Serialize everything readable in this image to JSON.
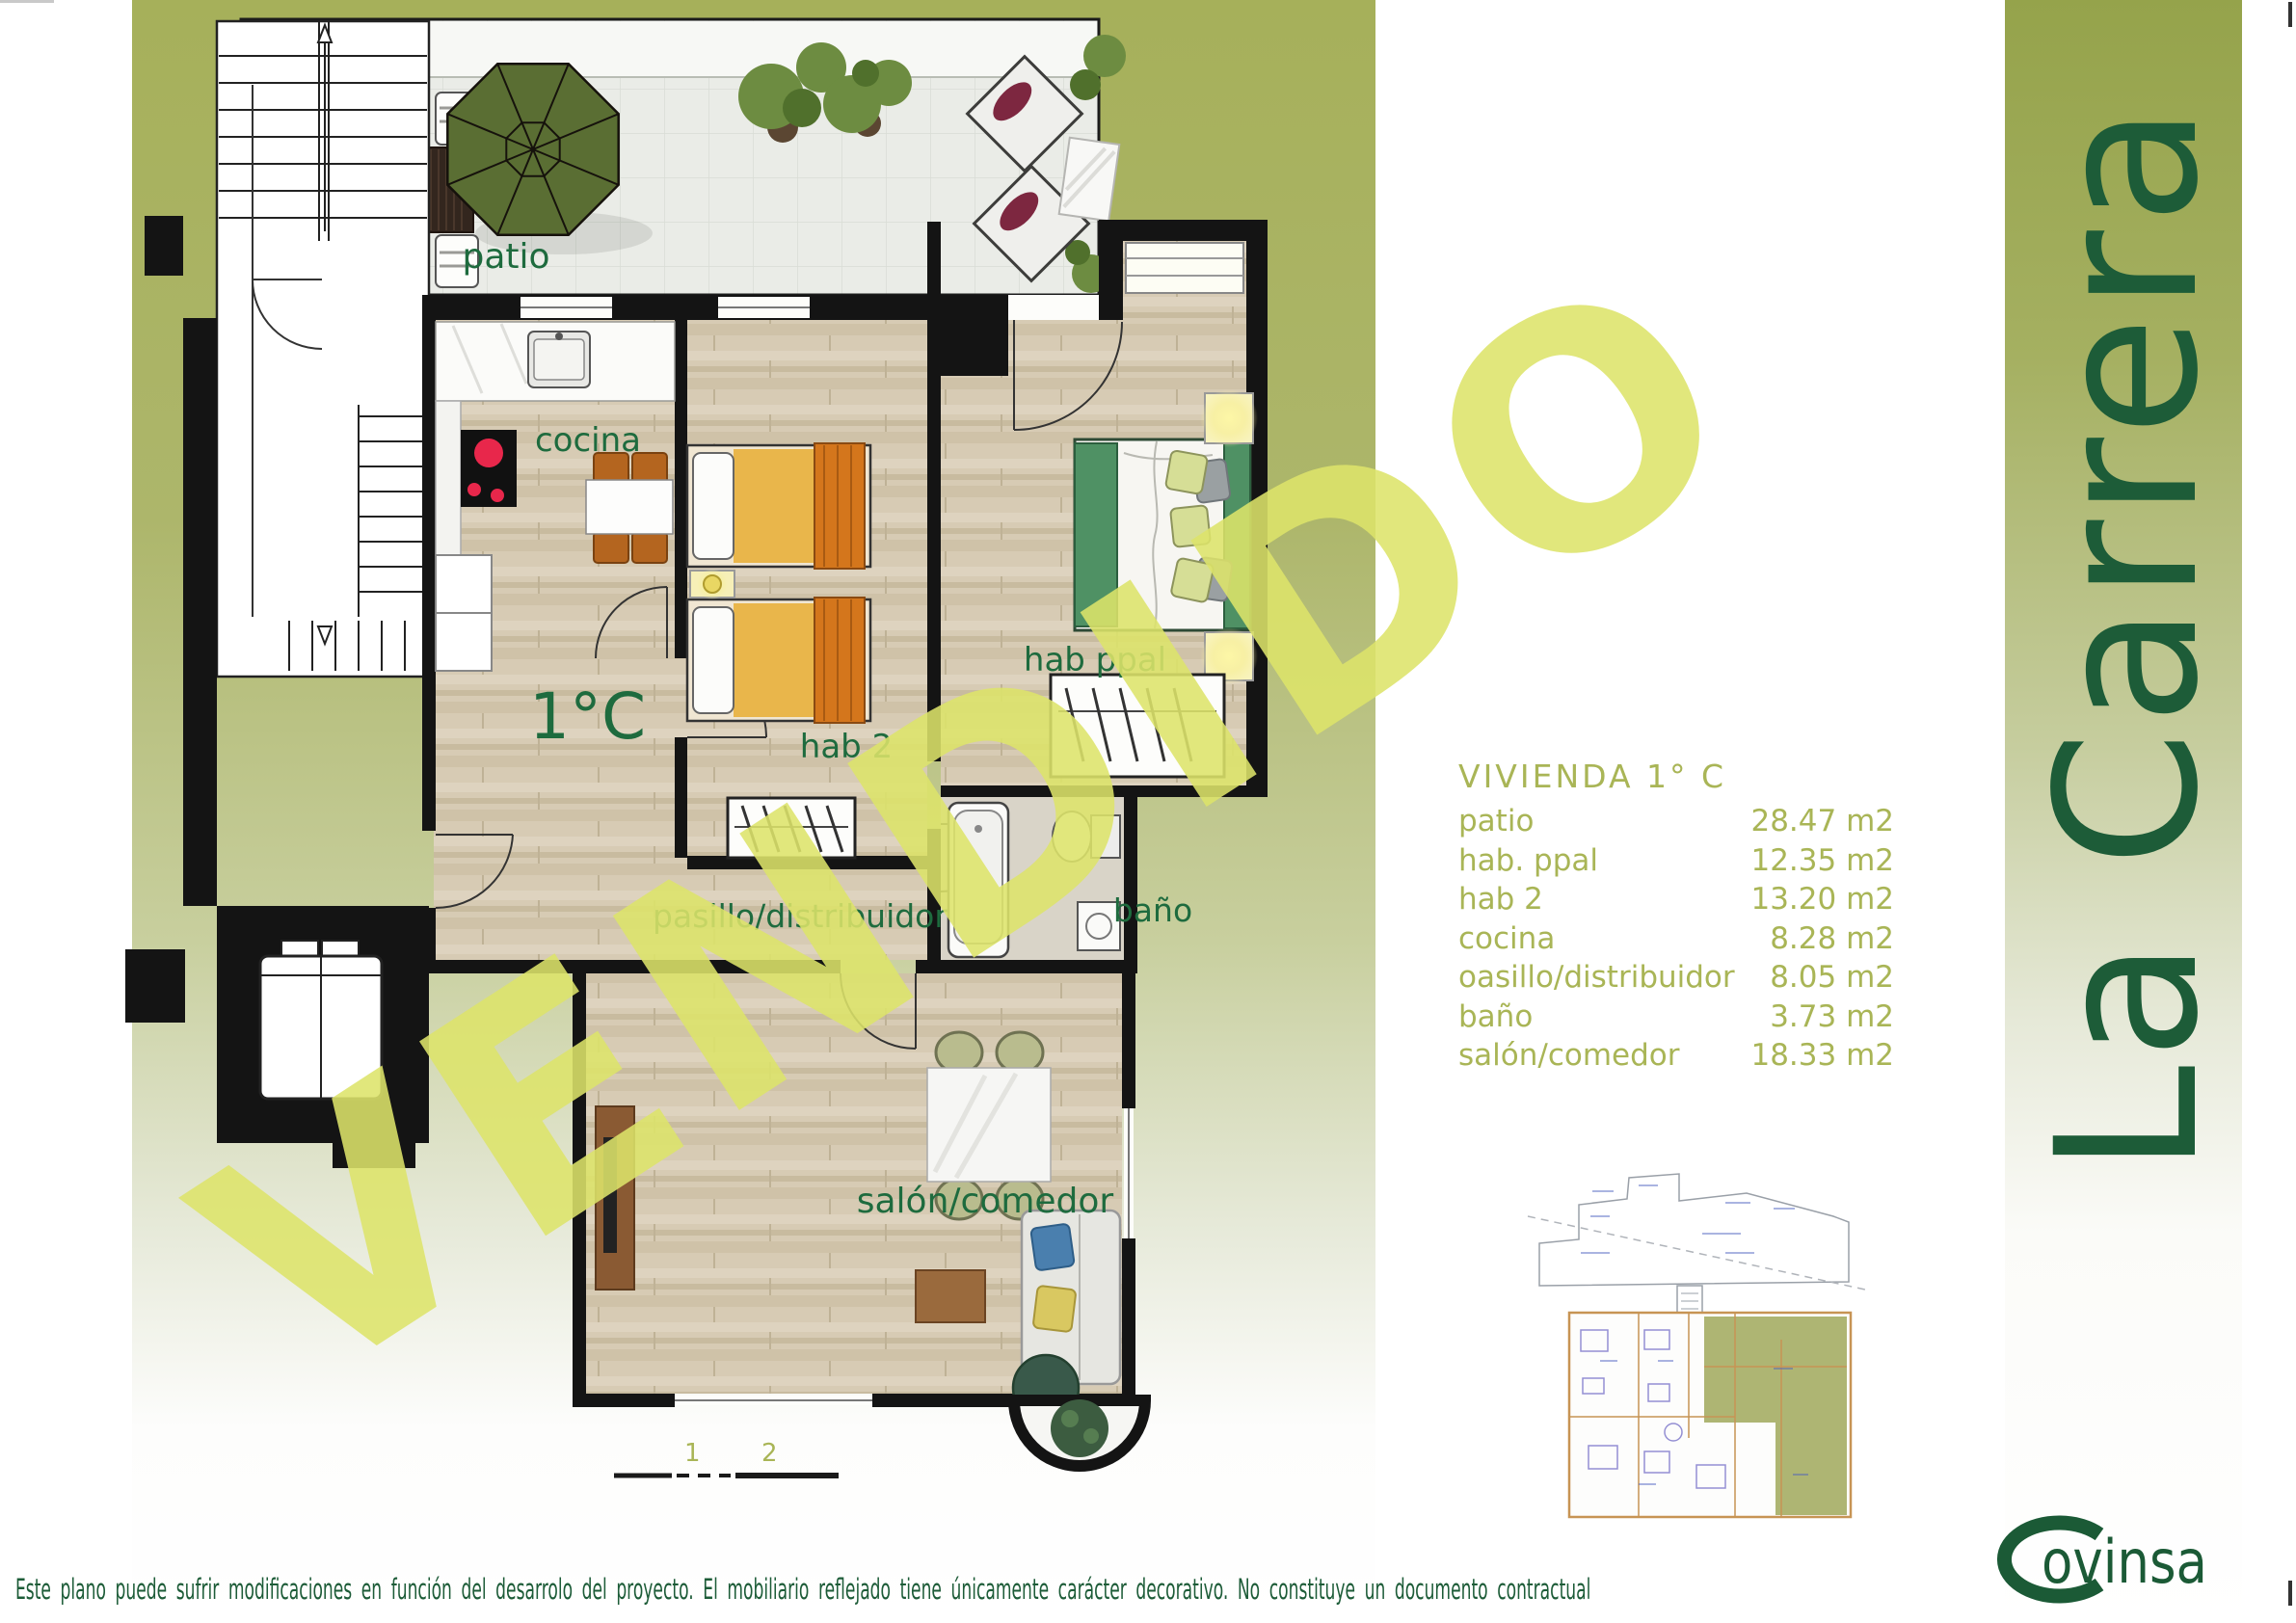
{
  "page": {
    "watermark": "VENDIDO",
    "disclaimer": "Este plano puede sufrir modificaciones en función del desarrolo del proyecto. El mobiliario reflejado tiene únicamente carácter decorativo. No constituye un documento contractual"
  },
  "plan": {
    "labels": {
      "patio": "patio",
      "cocina": "cocina",
      "hab2": "hab 2",
      "hab_ppal": "hab ppal",
      "pasillo": "pasillo/distribuidor",
      "bano": "baño",
      "salon": "salón/comedor",
      "unit": "1°C"
    },
    "scale_ticks": [
      "1",
      "2"
    ]
  },
  "area_table": {
    "title": "VIVIENDA 1° C",
    "rows": [
      {
        "label": "patio",
        "value": "28.47 m2"
      },
      {
        "label": "hab. ppal",
        "value": "12.35 m2"
      },
      {
        "label": "hab 2",
        "value": "13.20 m2"
      },
      {
        "label": "cocina",
        "value": "8.28 m2"
      },
      {
        "label": "oasillo/distribuidor",
        "value": "8.05 m2"
      },
      {
        "label": "baño",
        "value": "3.73 m2"
      },
      {
        "label": "salón/comedor",
        "value": "18.33 m2"
      }
    ]
  },
  "branding": {
    "project_name": "La Carrera",
    "company": "Covinsa",
    "logo_text": "ovinsa"
  },
  "colors": {
    "brand_green": "#1d5c38",
    "label_green": "#1e6b3e",
    "table_olive": "#a9b556",
    "watermark_yellow": "#dde46c",
    "background_olive": "#a6b05a"
  }
}
